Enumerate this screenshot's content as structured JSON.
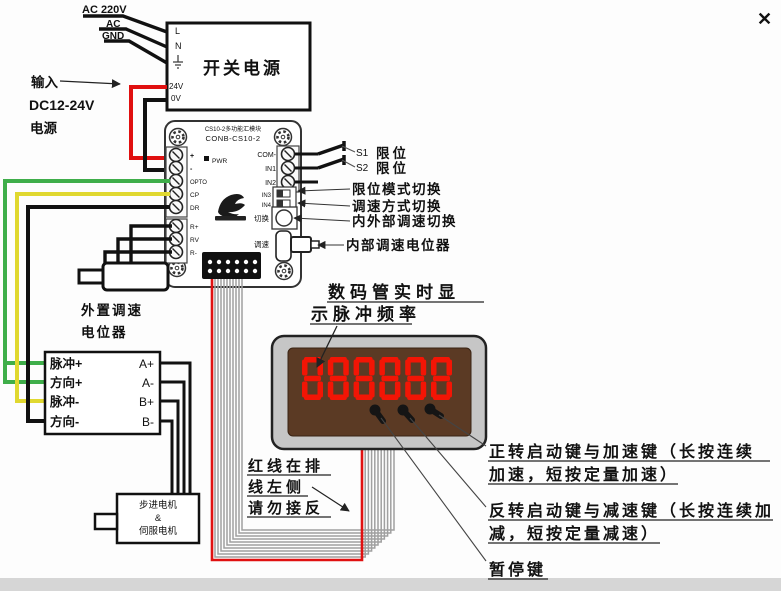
{
  "ac": {
    "line1": "AC 220V",
    "line2": "AC",
    "line3": "GND"
  },
  "psu": {
    "l": "L",
    "n": "N",
    "v24": "24V",
    "v0": "0V",
    "title": "开关电源"
  },
  "dc_input": {
    "l1": "输入",
    "l2": "DC12-24V",
    "l3": "电源"
  },
  "board": {
    "title_small": "CS10-2多功能汇模块",
    "model": "CONB-CS10-2",
    "pwr": "PWR",
    "t_plus": "+",
    "t_minus": "-",
    "t_opto": "OPTO",
    "t_cp": "CP",
    "t_dr": "DR",
    "t_rplus": "R+",
    "t_rv": "RV",
    "t_rminus": "R-",
    "t_com": "COM-",
    "t_in1": "IN1",
    "t_in2": "IN2",
    "t_in3": "IN3",
    "t_in4": "IN4",
    "lbl_switch": "切换",
    "lbl_speed": "调速"
  },
  "callouts": {
    "s1": "S1",
    "s1_limit": "限位",
    "s2": "S2",
    "s2_limit": "限位",
    "limit_mode": "限位模式切换",
    "speed_mode": "调速方式切换",
    "int_ext": "内外部调速切换",
    "internal_pot": "内部调速电位器"
  },
  "ext_pot": {
    "l1": "外置调速",
    "l2": "电位器"
  },
  "pulse_box": {
    "pul_p": "脉冲+",
    "dir_p": "方向+",
    "pul_m": "脉冲-",
    "dir_m": "方向-",
    "a_p": "A+",
    "a_m": "A-",
    "b_p": "B+",
    "b_m": "B-"
  },
  "motor": {
    "l1": "步进电机",
    "l2": "&",
    "l3": "伺服电机"
  },
  "display": {
    "value": "888888",
    "note1": "数码管实时显",
    "note2": "示脉冲频率"
  },
  "ribbon_note": {
    "l1": "红线在排",
    "l2": "线左侧",
    "l3": "请勿接反"
  },
  "keys": {
    "fwd1": "正转启动键与加速键（长按连续",
    "fwd2": "加速，短按定量加速）",
    "rev1": "反转启动键与减速键（长按连续加",
    "rev2": "减，短按定量减速）",
    "pause": "暂停键"
  },
  "colors": {
    "wire_red": "#e01010",
    "wire_green": "#3fae4a",
    "wire_yellow": "#e0d830",
    "wire_black": "#111111",
    "digit_red": "#f31505",
    "panel_brown": "#5b3a24",
    "bezel_gray": "#c6c6c6",
    "ribbon_gray": "#a0a0a0",
    "watermark": "#c9c9c9"
  }
}
